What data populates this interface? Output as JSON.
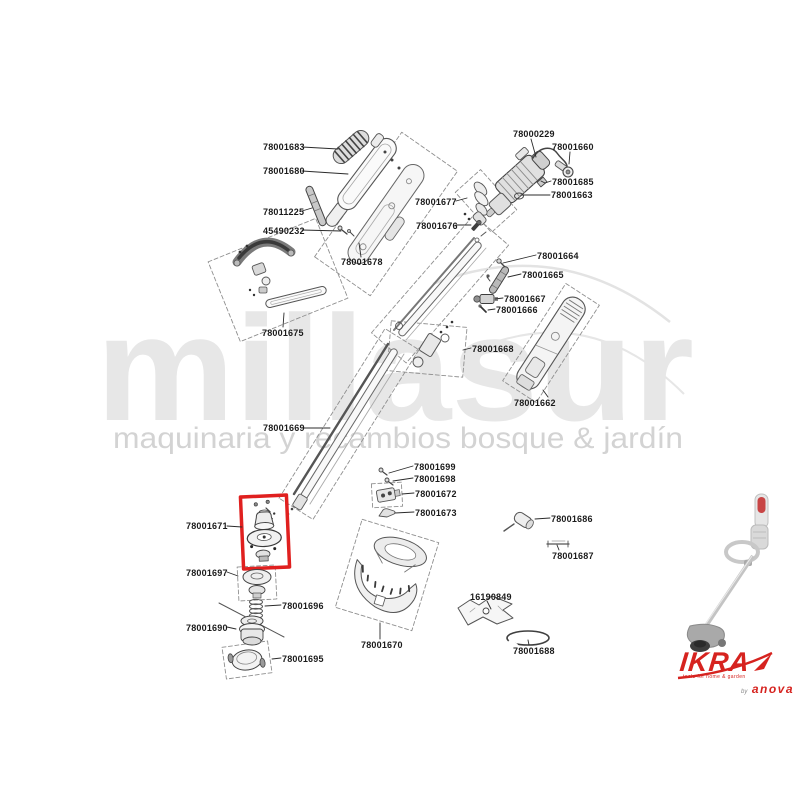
{
  "watermark": {
    "brand": "millasur",
    "tagline": "maquinaria y recambios bosque & jardín"
  },
  "diagram": {
    "highlighted_part": "78001671",
    "highlight_color": "#e0201f",
    "parts": [
      {
        "label": "78001683"
      },
      {
        "label": "78001680"
      },
      {
        "label": "78011225"
      },
      {
        "label": "45490232"
      },
      {
        "label": "78001678"
      },
      {
        "label": "78000229"
      },
      {
        "label": "78001660"
      },
      {
        "label": "78001685"
      },
      {
        "label": "78001663"
      },
      {
        "label": "78001677"
      },
      {
        "label": "78001676"
      },
      {
        "label": "78001664"
      },
      {
        "label": "78001665"
      },
      {
        "label": "78001667"
      },
      {
        "label": "78001666"
      },
      {
        "label": "78001668"
      },
      {
        "label": "78001662"
      },
      {
        "label": "78001675"
      },
      {
        "label": "78001669"
      },
      {
        "label": "78001699"
      },
      {
        "label": "78001698"
      },
      {
        "label": "78001672"
      },
      {
        "label": "78001673"
      },
      {
        "label": "78001671",
        "highlighted": true
      },
      {
        "label": "78001697"
      },
      {
        "label": "78001696"
      },
      {
        "label": "78001690"
      },
      {
        "label": "78001695"
      },
      {
        "label": "78001670"
      },
      {
        "label": "78001686"
      },
      {
        "label": "78001687"
      },
      {
        "label": "16190849"
      },
      {
        "label": "78001688"
      }
    ]
  },
  "branding": {
    "logo_text": "IKRA",
    "logo_tagline": "tools for home & garden",
    "byline_prefix": "by",
    "byline_brand": "anova",
    "logo_color": "#d6231f"
  }
}
